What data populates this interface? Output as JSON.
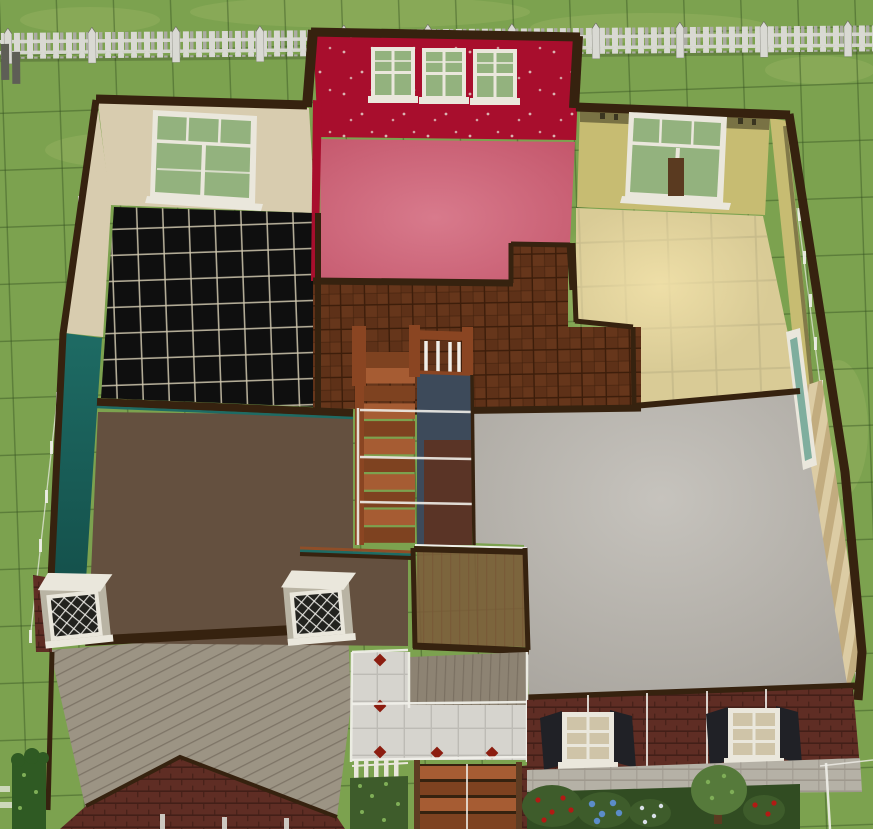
{
  "scene": {
    "type": "life-sim build mode, overhead rotated view of upper storey with cutaway walls",
    "lot": {
      "ground": "lawn with dark lot grid",
      "fence_top": "white picket fence",
      "lower_storey_outline": "thin white wall lines along lot sides"
    },
    "rooms": [
      {
        "name": "black-tile-room",
        "wall": "tan wallpaper",
        "floor": "black ceramic tile",
        "windows": 1
      },
      {
        "name": "crimson-room",
        "wall": "crimson starry wallpaper",
        "floor": "pink carpet",
        "windows": 3
      },
      {
        "name": "yellow-room",
        "wall": "pale yellow with animal border",
        "floor": "cream tile",
        "windows": 1
      },
      {
        "name": "brown-carpet-room",
        "wall": "teal paint",
        "floor": "brown carpet",
        "window_boxes": 2
      },
      {
        "name": "gray-carpet-room",
        "wall": "striped beige wallpaper",
        "floor": "gray carpet",
        "windows": 1
      },
      {
        "name": "hallway",
        "wall": "cutaway",
        "floor": "dark oak parquet",
        "feature": "staircase with railed stairwell"
      }
    ],
    "stairs": {
      "interior": "oak staircase descending through stairwell",
      "exterior": "wooden porch steps"
    },
    "exterior": {
      "cladding": "red brick",
      "foundation": "concrete block",
      "deck": "weathered gray plank deck with brick gable below",
      "patio": "white tile patio with red diamond accents",
      "shuttered_windows": 2,
      "plants": [
        "hedge",
        "rose bush",
        "blue hydrangea bush",
        "white blossom bush",
        "small tree",
        "rose bush",
        "porch greenery"
      ]
    },
    "colors": {
      "grass": "#7CA24F",
      "grass_light": "#9CB465",
      "grid_line": "#33511E",
      "fence_white": "#D9D9D3",
      "fence_mid": "#ABABA3",
      "fence_dark": "#6A6A60",
      "post_dark": "#5E5E56",
      "trim_dark": "#36220F",
      "trim_mid": "#5E3C22",
      "trim_orange": "#8F4E28",
      "wall_tan": "#D8CCAF",
      "wall_crimson": "#A80E2D",
      "crimson_dot": "#E6DCD2",
      "wall_yellow": "#C7BC72",
      "border_olive": "#70693F",
      "border_mark": "#3A3520",
      "wall_teal": "#1E6B64",
      "teal_deep": "#124B46",
      "stripe_a": "#DCCCA4",
      "stripe_b": "#C2AC7F",
      "floor_black": "#0F0F0F",
      "grout_black": "#CFC7AE",
      "floor_pink": "#C4576C",
      "floor_pink_light": "#D87A8C",
      "floor_cream": "#D9CB96",
      "floor_cream_glow": "#F2E2AA",
      "grout_cream": "#C6B98A",
      "parquet": "#5E3118",
      "parquet_line": "#3C1D0A",
      "parquet_light": "#703D1E",
      "floor_gray": "#A7A39C",
      "floor_gray_light": "#C6C3BD",
      "carpet_brown": "#64503F",
      "deck_gray": "#9C9484",
      "deck_line": "#5F564A",
      "porch_gray": "#8D8373",
      "porch_line": "#6E6456",
      "landing_brown": "#7D5A3A",
      "landing_line": "#5C4026",
      "stair_wood": "#A65C33",
      "stair_dark": "#7E4220",
      "rail_wood": "#8A4522",
      "stairwell_blue": "#3D4A5A",
      "lower_brown": "#5A3426",
      "white_line": "#F0EFE9",
      "brick": "#5F2D24",
      "brick_line": "#431F18",
      "concrete": "#B5B1A6",
      "concrete_line": "#989287",
      "patio_tile": "#D6D4CE",
      "patio_grout": "#BDBBB5",
      "patio_diamond": "#8C1D10",
      "shutter": "#202126",
      "window_frame": "#EAE7DC",
      "frame_shadow": "#B9B4A4",
      "glass_green": "#93B27E",
      "glass_teal": "#7FAE9E",
      "pane_tan": "#CFC4A8",
      "bush_green": "#3E5C2B",
      "bush_light": "#7FAE57",
      "bush_band": "#314C22",
      "hedge": "#2F5A23",
      "rose_red": "#B21A14",
      "hydrangea": "#5B8CC8",
      "blossom": "#D9DFE8",
      "tree_green": "#567A3B",
      "trunk": "#5A3A20",
      "lattice_dark": "#22221E"
    }
  }
}
